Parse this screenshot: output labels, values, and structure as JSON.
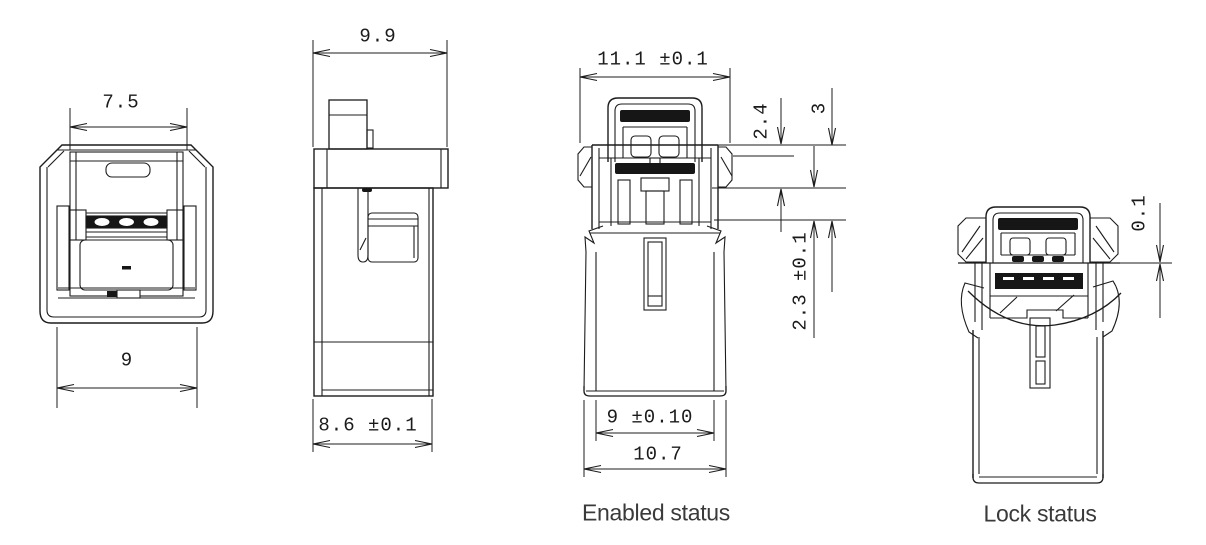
{
  "views": {
    "front": {
      "dim_top": "7.5",
      "dim_bottom": "9"
    },
    "side": {
      "dim_top": "9.9",
      "dim_bottom": "8.6 ±0.1"
    },
    "enabled": {
      "dim_top": "11.1 ±0.1",
      "dim_right_upper": "2.4",
      "dim_right_outer": "3",
      "dim_right_lower": "2.3 ±0.1",
      "dim_bottom_inner": "9 ±0.10",
      "dim_bottom_outer": "10.7",
      "label": "Enabled status"
    },
    "lock": {
      "dim_gap": "0.1",
      "label": "Lock status"
    }
  },
  "colors": {
    "line": "#1c1c1c",
    "fill_dark": "#161616",
    "dim_text": "#1b1b1b",
    "label_text": "#3a3a3a",
    "background": "#ffffff"
  }
}
